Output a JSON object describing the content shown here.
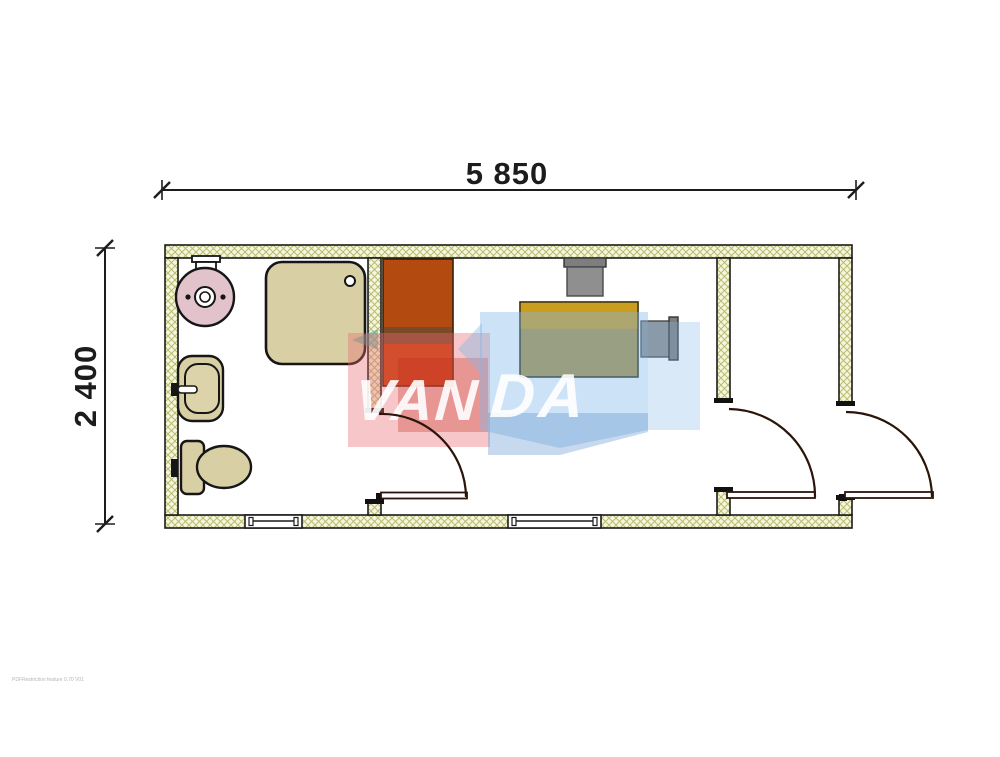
{
  "drawing": {
    "type": "floor-plan",
    "title": "container cabin floor plan",
    "top_dimension_label": "5 850",
    "left_dimension_label": "2 400",
    "watermark": {
      "brand": "VANDA",
      "brand_first": "VAN",
      "brand_second": "DA"
    },
    "fineprint": "PDFRestriction feature 0.70 V01",
    "fixtures": [
      "water-heater",
      "shower-cabin",
      "washbasin",
      "toilet",
      "wardrobe",
      "desk",
      "chair-top",
      "chair-right"
    ],
    "doors": [
      "bathroom-door",
      "middle-room-door",
      "exterior-door"
    ],
    "windows": [
      "bathroom-window",
      "office-window"
    ],
    "colors": {
      "wall_fill": "#f5f6dc",
      "wall_hatch": "#b9bc72",
      "outline": "#1b1b1b",
      "fixture_tan": "#d9cfa5",
      "heater_pink": "#e2c3cc",
      "wardrobe_orange": "#b34a0f",
      "wardrobe_band": "#7d4a29",
      "wardrobe_red": "#c53e04",
      "desk_gold": "#cb9d1e",
      "desk_olive": "#a98f3e",
      "chair_gray": "#8f8f8f",
      "watermark_pink": "#e86870",
      "watermark_red": "#c62a1c",
      "watermark_blue": "#80b6e8",
      "watermark_teal": "#46a59b",
      "door_line": "#2b150b"
    }
  }
}
